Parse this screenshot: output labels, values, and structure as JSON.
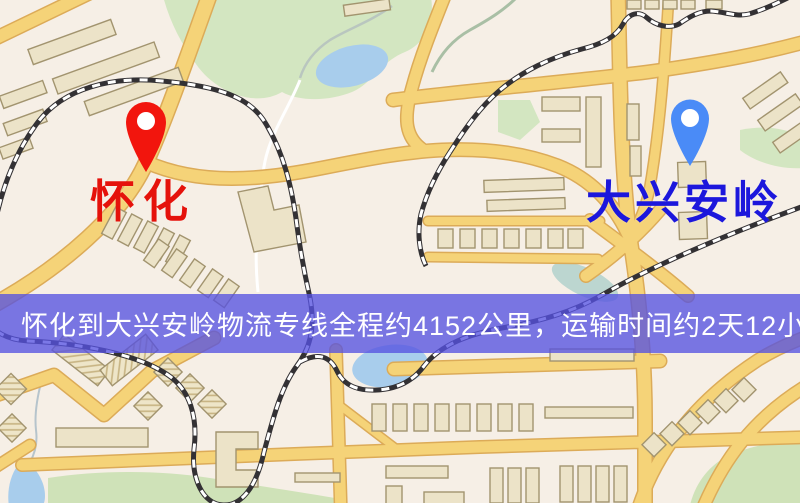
{
  "banner": {
    "text": "怀化到大兴安岭物流专线全程约4152公里，运输时间约2天12小时.",
    "background_color": "#5652e0",
    "text_color": "#ffffff"
  },
  "origin": {
    "label": "怀化",
    "label_color": "#e5120b",
    "pin_color": "#f2150d"
  },
  "destination": {
    "label": "大兴安岭",
    "label_color": "#1c17dc",
    "pin_color": "#4a8bf7"
  },
  "route": {
    "distance_km": "4152",
    "duration": "2天12小时"
  },
  "map_palette": {
    "background": "#f6efe6",
    "road": "#f5d378",
    "road_casing": "#dcab58",
    "green_area": "#d3e6c1",
    "water": "#a8cdec",
    "building": "#ece3c8",
    "railway": "#333134"
  }
}
